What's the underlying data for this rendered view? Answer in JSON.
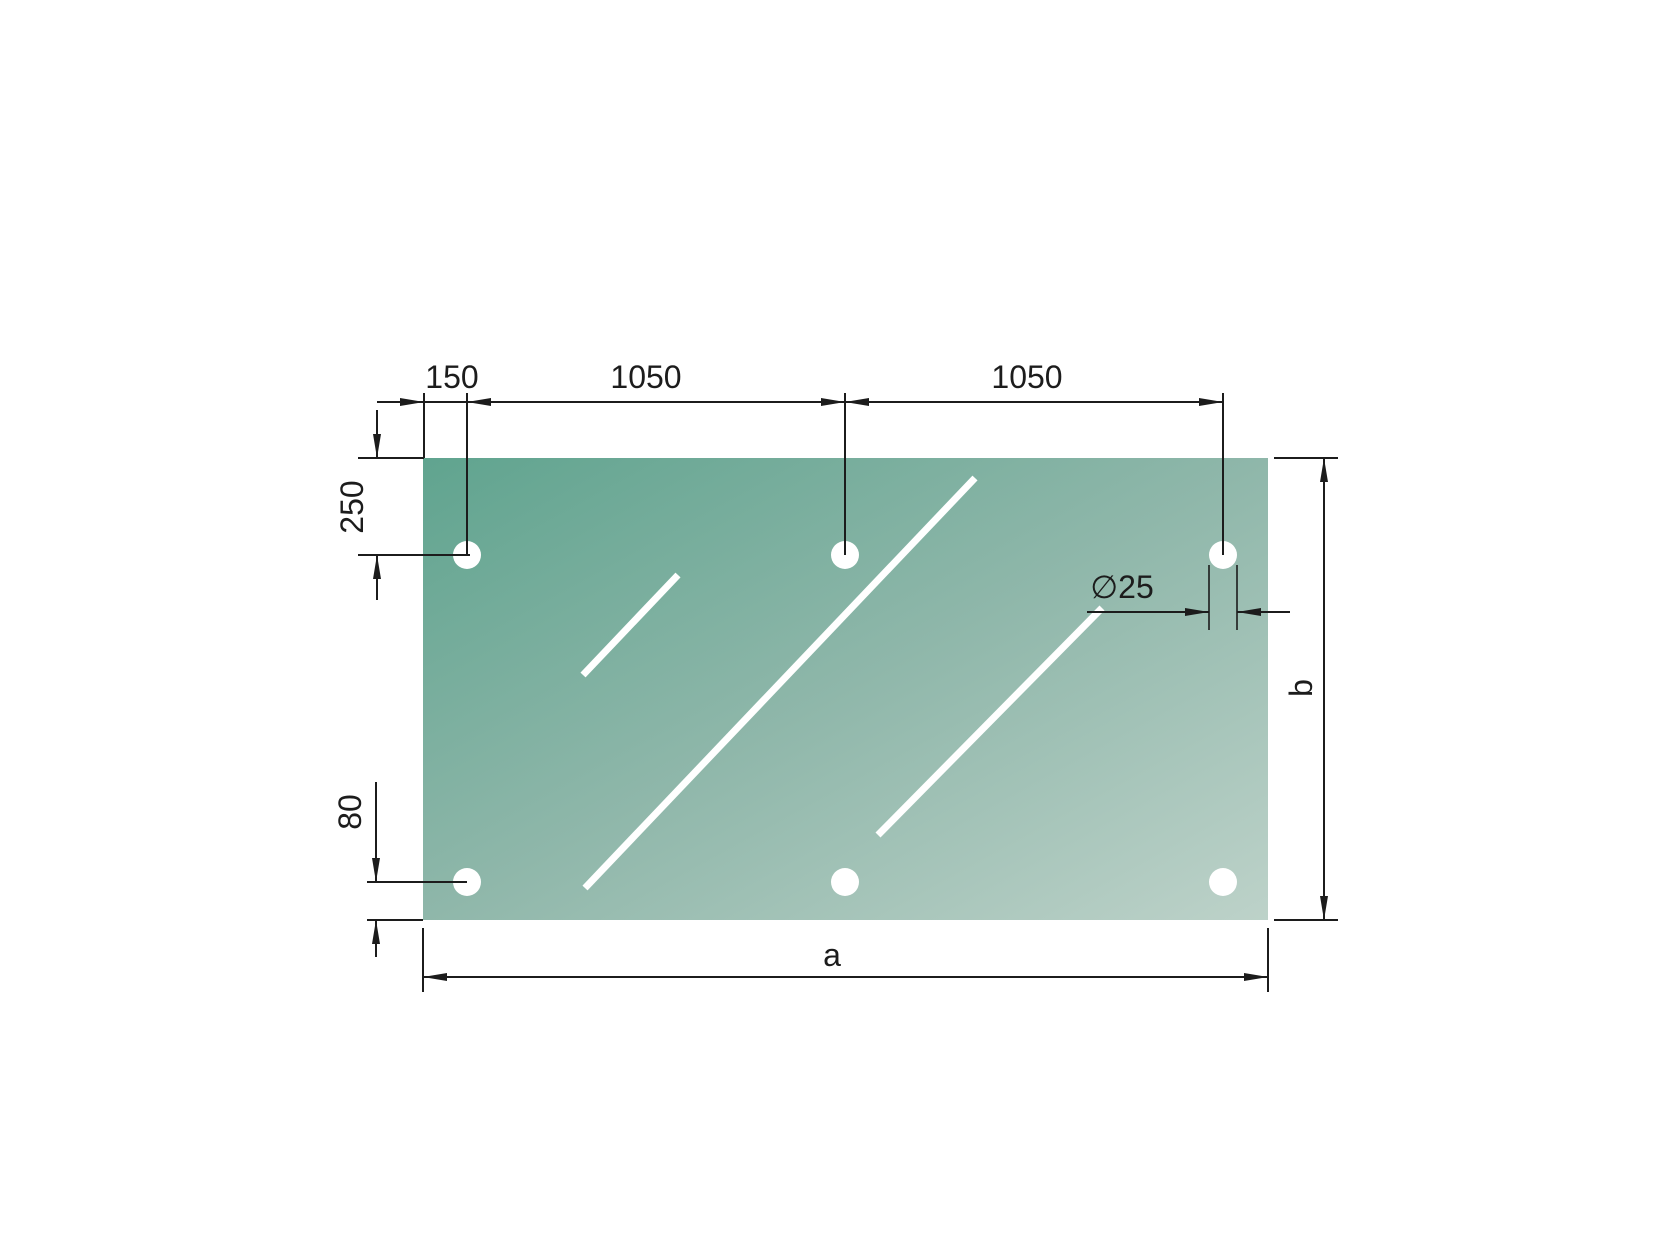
{
  "drawing": {
    "description": "Technical drawing of a glass panel with six drill holes and dimension annotations",
    "background_color": "#ffffff",
    "line_color": "#1c1c1c",
    "panel": {
      "gradient_start": "#60a48f",
      "gradient_mid": "#8fb7aa",
      "gradient_end": "#bdd2c9",
      "hole_color": "#ffffff",
      "reflection_color": "#ffffff",
      "hole_count": 6
    },
    "dimensions": {
      "left_edge_to_first_hole": {
        "label": "150",
        "value": 150
      },
      "hole_spacing_1": {
        "label": "1050",
        "value": 1050
      },
      "hole_spacing_2": {
        "label": "1050",
        "value": 1050
      },
      "top_edge_to_hole": {
        "label": "250",
        "value": 250
      },
      "bottom_edge_to_hole": {
        "label": "80",
        "value": 80
      },
      "hole_diameter": {
        "label": "∅25",
        "value": 25
      },
      "overall_width": {
        "label": "a"
      },
      "overall_height": {
        "label": "b"
      }
    }
  }
}
